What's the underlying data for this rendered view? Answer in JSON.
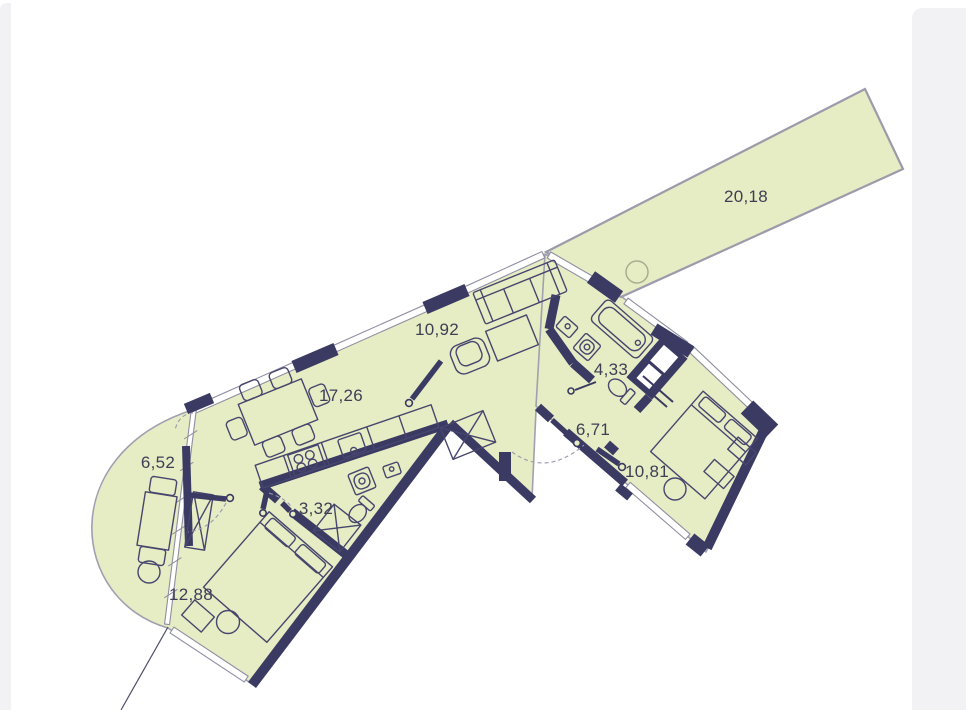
{
  "rooms": {
    "terrace": {
      "area": "20,18"
    },
    "living": {
      "area": "10,92"
    },
    "kitchen_living": {
      "area": "17,26"
    },
    "balcony": {
      "area": "6,52"
    },
    "bathroom_small": {
      "area": "3,32"
    },
    "bedroom_primary": {
      "area": "12,88"
    },
    "bathroom": {
      "area": "4,33"
    },
    "hallway": {
      "area": "6,71"
    },
    "bedroom_secondary": {
      "area": "10,81"
    }
  },
  "colors": {
    "floor_fill": "#e6ecc3",
    "wall": "#3a3a63",
    "window_line": "#8f8fa3",
    "terrace_border": "#9b9bab",
    "label_text": "#3e3e55",
    "side_panel": "#f2f2f4"
  }
}
